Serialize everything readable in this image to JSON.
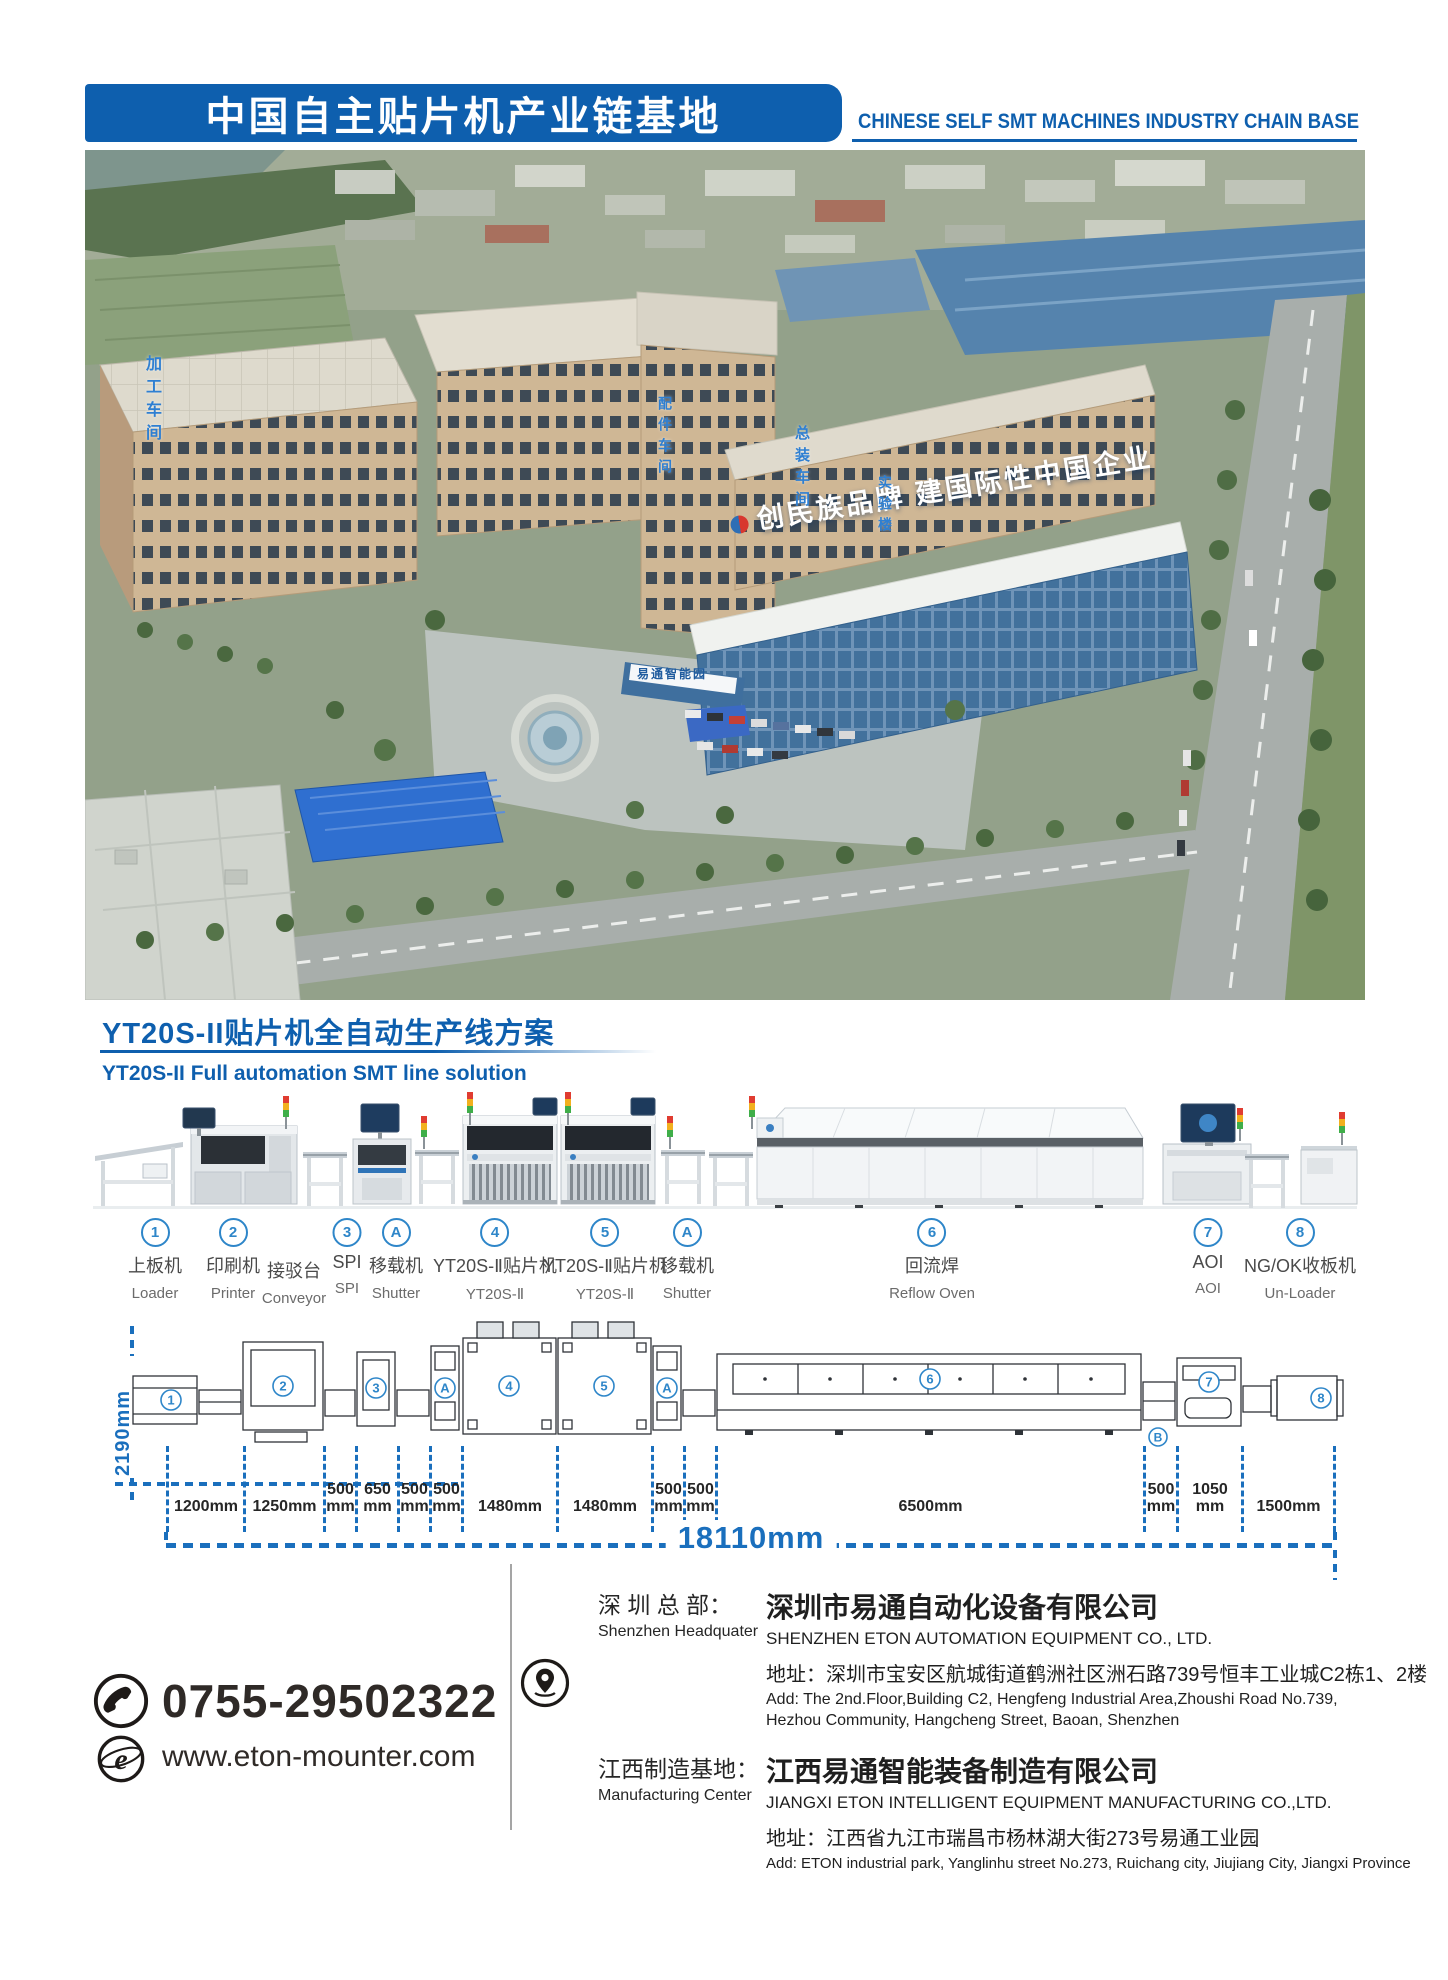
{
  "header": {
    "title_cn": "中国自主贴片机产业链基地",
    "title_en": "CHINESE SELF SMT MACHINES INDUSTRY CHAIN BASE"
  },
  "photo": {
    "slogan": "创民族品牌 建国际性中国企业",
    "gate_sign": "易通智能园",
    "building_labels": [
      "加工车间",
      "配件车间",
      "总装车间",
      "实验楼"
    ]
  },
  "section": {
    "title_cn": "YT20S-II贴片机全自动生产线方案",
    "subtitle_en": "YT20S-II Full automation SMT line solution"
  },
  "stations": [
    {
      "badge": "1",
      "cn": "上板机",
      "en": "Loader"
    },
    {
      "badge": "2",
      "cn": "印刷机",
      "en": "Printer"
    },
    {
      "badge": "",
      "cn": "接驳台",
      "en": "Conveyor"
    },
    {
      "badge": "3",
      "cn": "SPI",
      "en": "SPI"
    },
    {
      "badge": "A",
      "cn": "移载机",
      "en": "Shutter"
    },
    {
      "badge": "4",
      "cn": "YT20S-Ⅱ贴片机",
      "en": "YT20S-Ⅱ"
    },
    {
      "badge": "5",
      "cn": "YT20S-Ⅱ贴片机",
      "en": "YT20S-Ⅱ"
    },
    {
      "badge": "A",
      "cn": "移载机",
      "en": "Shutter"
    },
    {
      "badge": "6",
      "cn": "回流焊",
      "en": "Reflow Oven"
    },
    {
      "badge": "7",
      "cn": "AOI",
      "en": "AOI"
    },
    {
      "badge": "8",
      "cn": "NG/OK收板机",
      "en": "Un-Loader"
    }
  ],
  "topview_markers": [
    "1",
    "2",
    "3",
    "A",
    "4",
    "5",
    "A",
    "6",
    "B",
    "7",
    "8"
  ],
  "dimensions": {
    "depth_label": "2190mm",
    "segments": [
      {
        "v": "1200",
        "u": "mm"
      },
      {
        "v": "1250",
        "u": "mm"
      },
      {
        "v": "500",
        "u": "mm"
      },
      {
        "v": "650",
        "u": "mm"
      },
      {
        "v": "500",
        "u": "mm"
      },
      {
        "v": "500",
        "u": "mm"
      },
      {
        "v": "1480",
        "u": "mm"
      },
      {
        "v": "1480",
        "u": "mm"
      },
      {
        "v": "500",
        "u": "mm"
      },
      {
        "v": "500",
        "u": "mm"
      },
      {
        "v": "6500",
        "u": "mm"
      },
      {
        "v": "500",
        "u": "mm"
      },
      {
        "v": "1050",
        "u": "mm"
      },
      {
        "v": "1500",
        "u": "mm"
      }
    ],
    "total_label": "18110mm"
  },
  "contact": {
    "phone": "0755-29502322",
    "website": "www.eton-mounter.com"
  },
  "locations": [
    {
      "label_cn": "深 圳 总 部：",
      "label_en": "Shenzhen Headquater",
      "company_cn": "深圳市易通自动化设备有限公司",
      "company_en": "SHENZHEN ETON AUTOMATION EQUIPMENT CO., LTD.",
      "addr_cn": "地址：深圳市宝安区航城街道鹤洲社区洲石路739号恒丰工业城C2栋1、2楼",
      "addr_en": "Add: The 2nd.Floor,Building C2, Hengfeng Industrial Area,Zhoushi Road No.739, Hezhou Community, Hangcheng Street, Baoan, Shenzhen"
    },
    {
      "label_cn": "江西制造基地：",
      "label_en": "Manufacturing Center",
      "company_cn": "江西易通智能装备制造有限公司",
      "company_en": "JIANGXI ETON INTELLIGENT EQUIPMENT MANUFACTURING CO.,LTD.",
      "addr_cn": "地址：江西省九江市瑞昌市杨林湖大街273号易通工业园",
      "addr_en": "Add: ETON industrial park, Yanglinhu street No.273, Ruichang city, Jiujiang City, Jiangxi Province"
    }
  ],
  "colors": {
    "accent": "#0e5fae",
    "diagram_blue": "#1a6fbd",
    "badge_blue": "#2e86c9",
    "signal_red": "#e03c31",
    "signal_yellow": "#f2b01e",
    "signal_green": "#3fae49"
  }
}
